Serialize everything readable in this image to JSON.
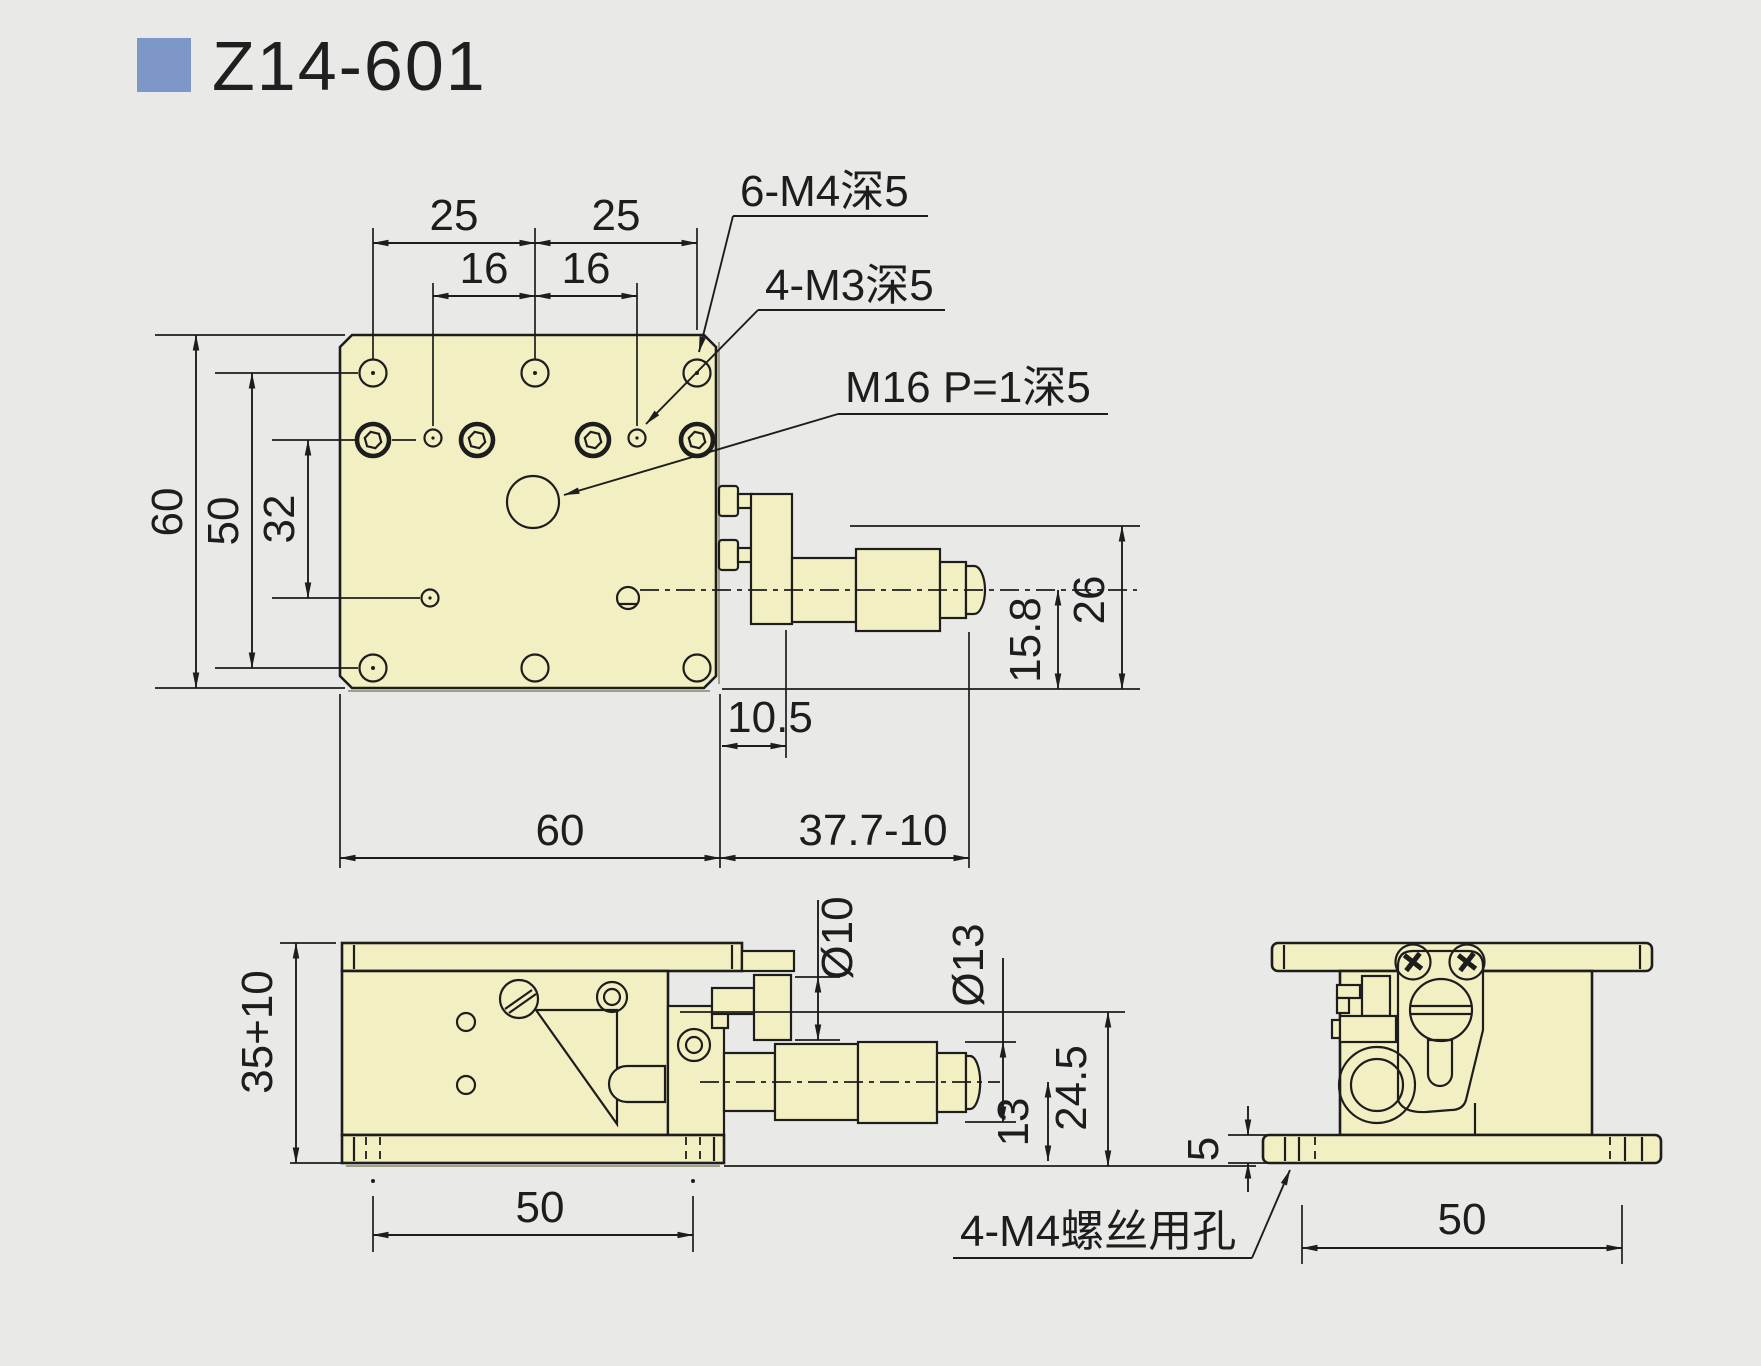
{
  "title": {
    "code": "Z14-601"
  },
  "colors": {
    "background": "#e9e9e7",
    "part_fill": "#f2f0c2",
    "line": "#1d1d1d",
    "accent_blue": "#7d97c8"
  },
  "top_view": {
    "dims": {
      "d25_left": "25",
      "d25_right": "25",
      "d16_left": "16",
      "d16_right": "16",
      "d60_left": "60",
      "d50_left": "50",
      "d32": "32",
      "d60_bottom": "60",
      "d10_5": "10.5",
      "d37_7": "37.7-10",
      "d15_8": "15.8",
      "d26": "26"
    },
    "labels": {
      "m4_holes": "6-M4深5",
      "m3_holes": "4-M3深5",
      "m16_thread": "M16 P=1深5"
    }
  },
  "side_view": {
    "dims": {
      "d35_10": "35+10",
      "dia10": "Ø10",
      "dia13": "Ø13",
      "d13": "13",
      "d24_5": "24.5",
      "d50": "50"
    }
  },
  "end_view": {
    "dims": {
      "d5": "5",
      "d50": "50"
    },
    "labels": {
      "m4_clearance": "4-M4螺丝用孔"
    }
  }
}
